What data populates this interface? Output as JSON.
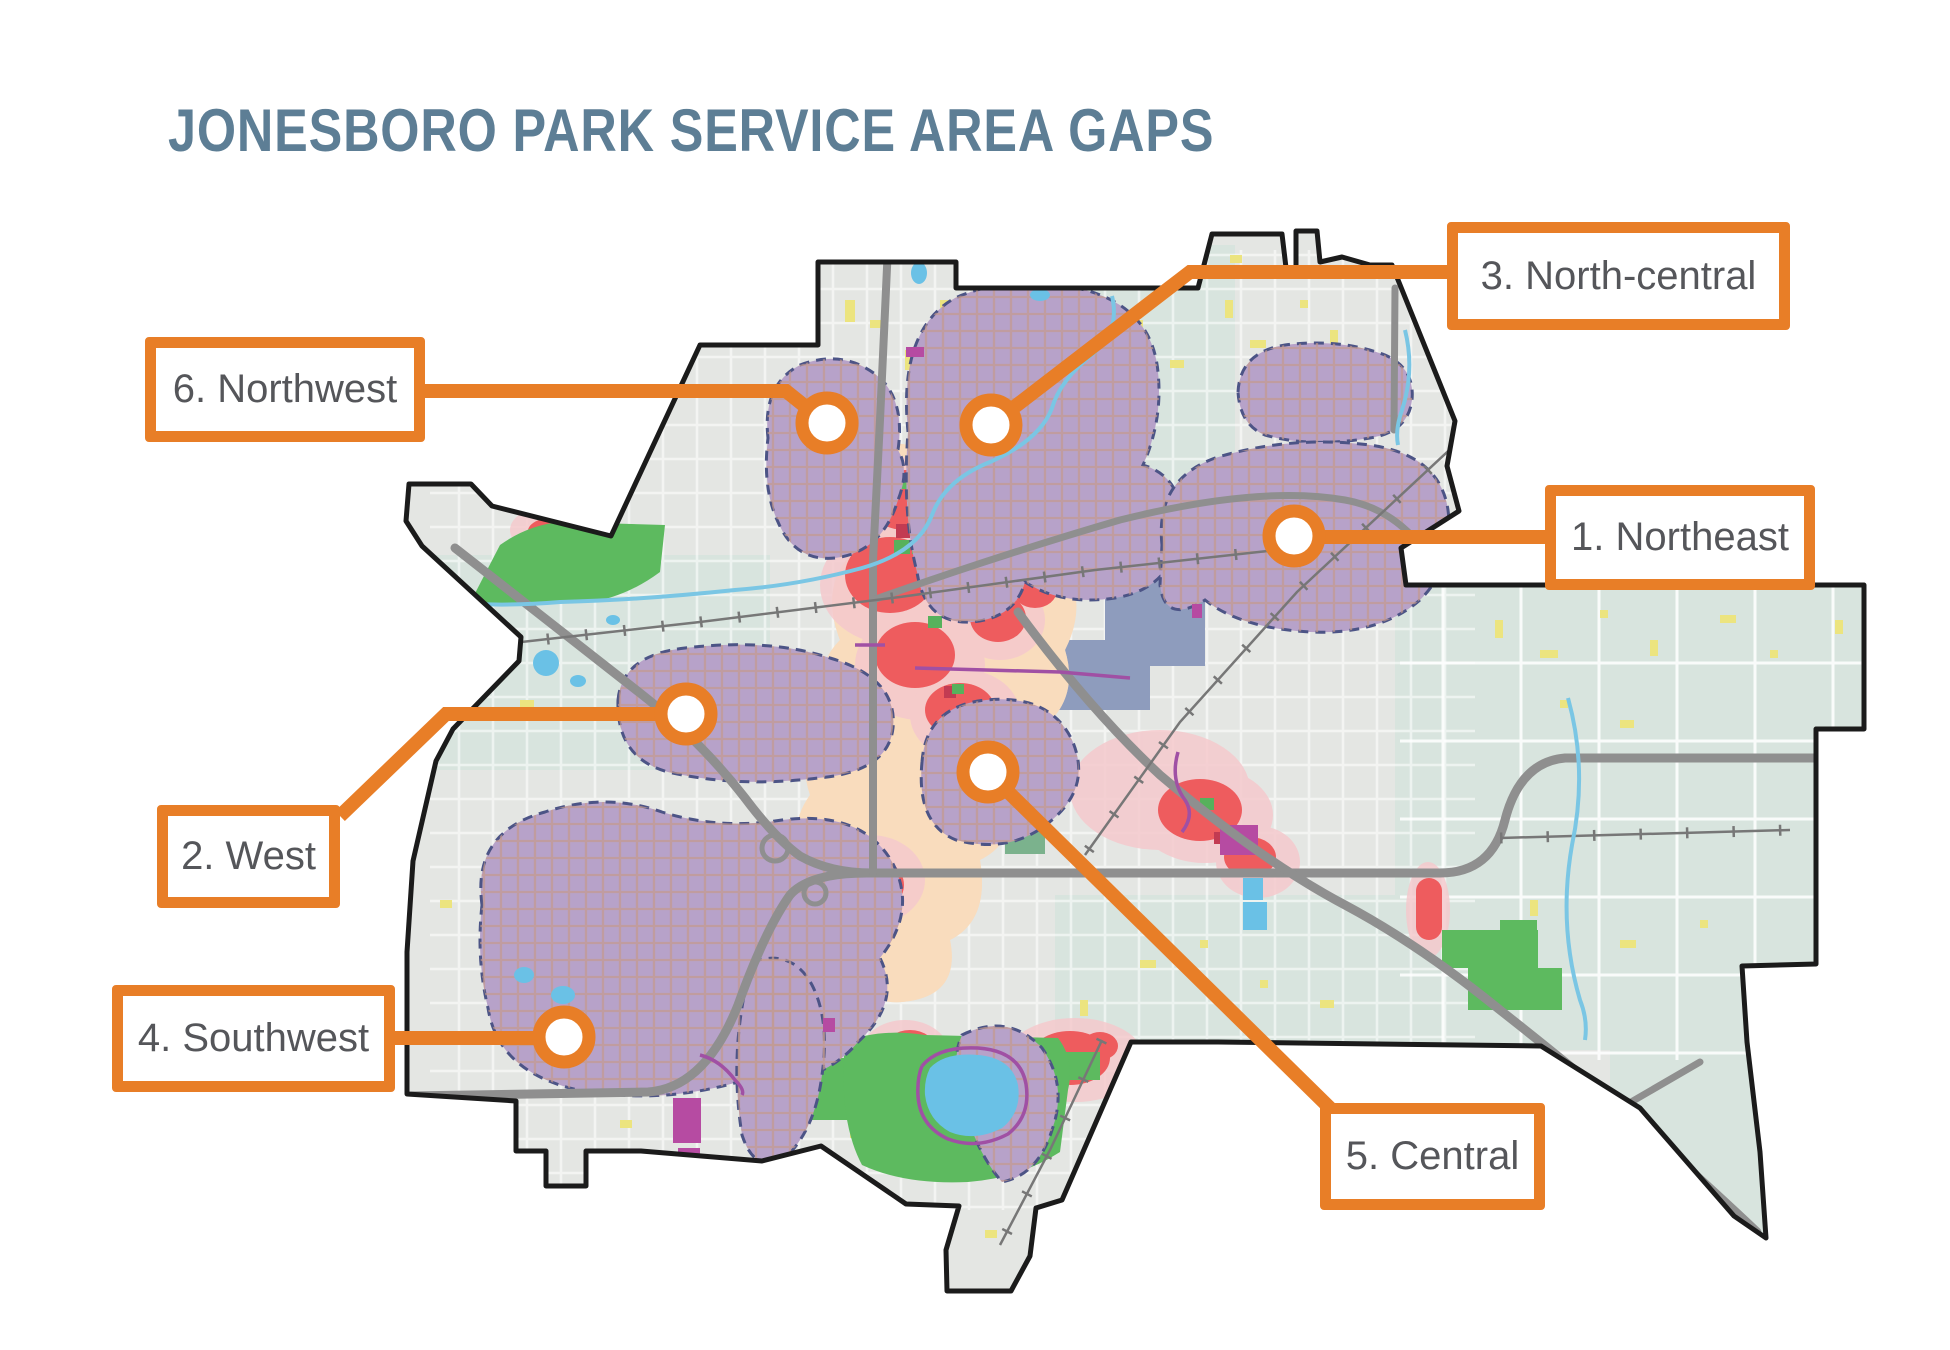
{
  "title": "JONESBORO PARK SERVICE AREA GAPS",
  "callouts": {
    "northeast": {
      "label": "1. Northeast"
    },
    "west": {
      "label": "2. West"
    },
    "north_central": {
      "label": "3. North-central"
    },
    "southwest": {
      "label": "4. Southwest"
    },
    "central": {
      "label": "5. Central"
    },
    "northwest": {
      "label": "6. Northwest"
    }
  },
  "colors": {
    "accent_orange": "#E87E27",
    "title_blue": "#5D7E95",
    "label_text": "#55565A",
    "gap_purple": "#B7A2C9",
    "gap_dash_border": "#4C5486",
    "heat_red": "#EE5C5E",
    "heat_pink": "#F5C9CD",
    "heat_peach": "#F8DCBD",
    "park_green": "#5DBA5F",
    "water_blue": "#6AC1E6",
    "campus_slate": "#8E9CBD",
    "road_yellow": "#ECE47F",
    "highway_gray": "#8F8F8F",
    "trail_magenta": "#A050A4",
    "parcel_magenta": "#B64BA2",
    "boundary_black": "#1B1B1B"
  }
}
